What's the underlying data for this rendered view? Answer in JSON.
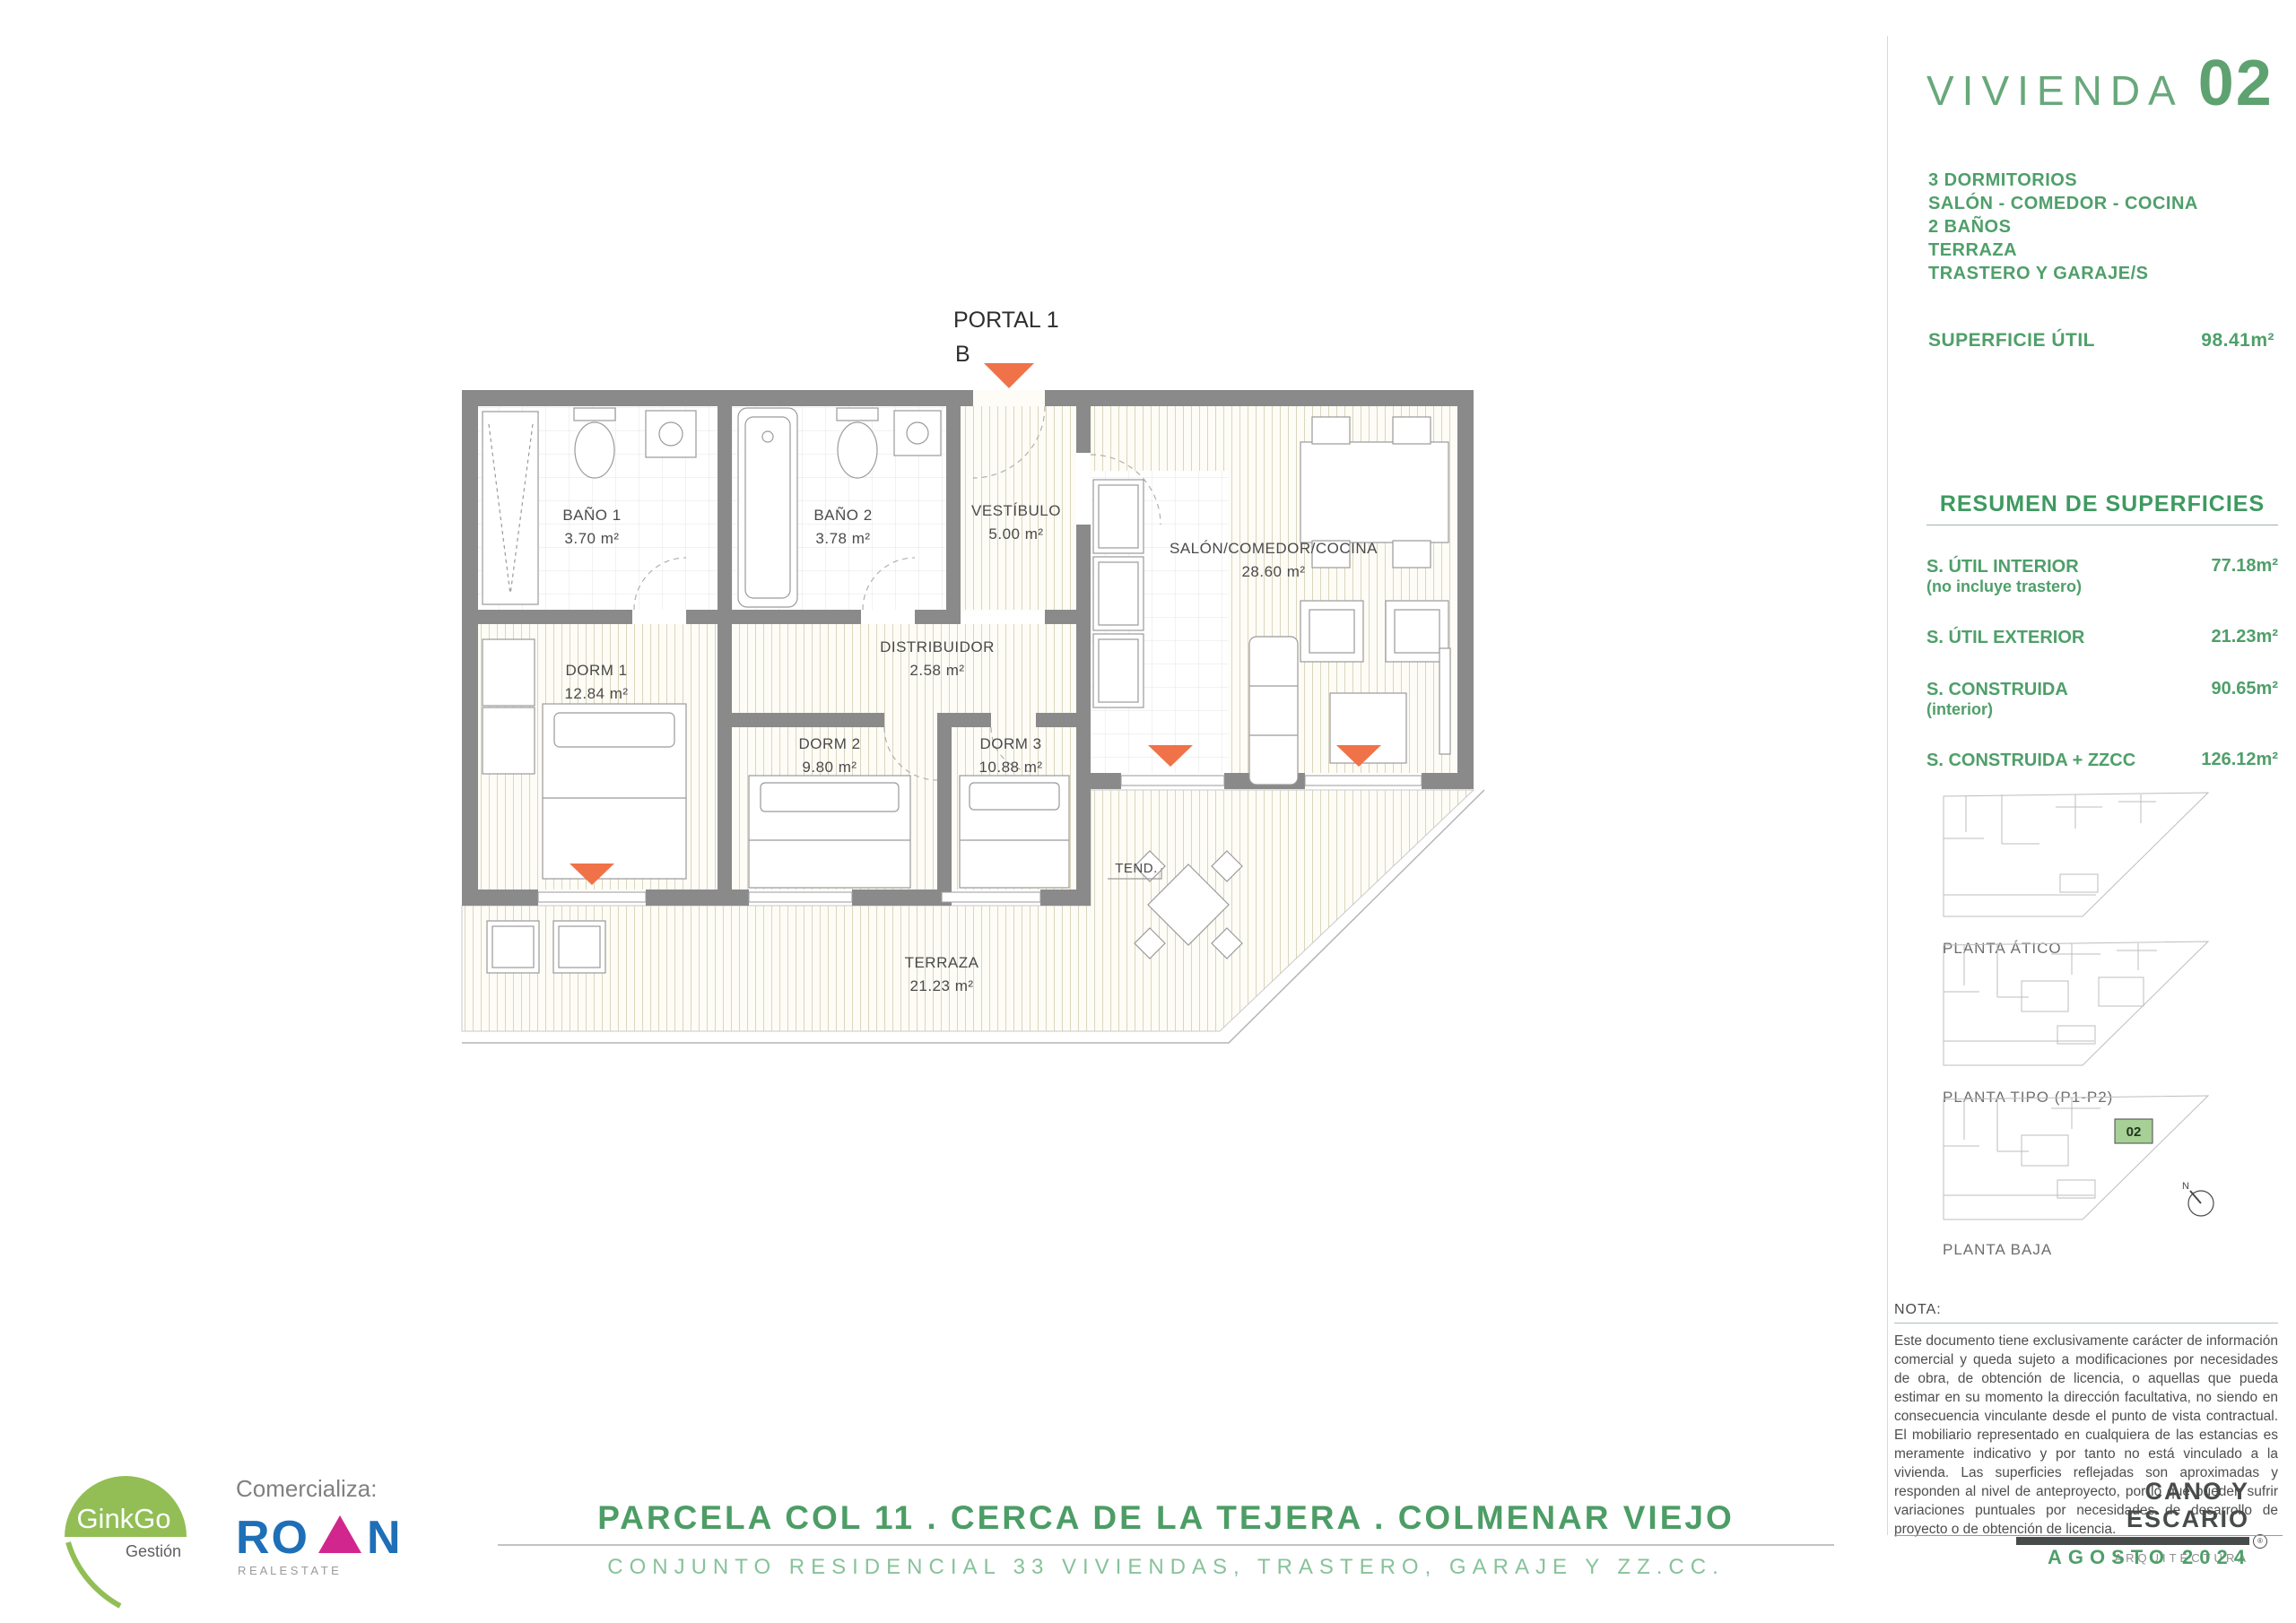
{
  "plan": {
    "portal_label": "PORTAL 1",
    "portal_letter": "B",
    "rooms": {
      "bano1": {
        "name": "BAÑO 1",
        "area": "3.70 m²"
      },
      "bano2": {
        "name": "BAÑO 2",
        "area": "3.78 m²"
      },
      "vestibulo": {
        "name": "VESTÍBULO",
        "area": "5.00 m²"
      },
      "distribuidor": {
        "name": "DISTRIBUIDOR",
        "area": "2.58 m²"
      },
      "dorm1": {
        "name": "DORM 1",
        "area": "12.84 m²"
      },
      "dorm2": {
        "name": "DORM 2",
        "area": "9.80 m²"
      },
      "dorm3": {
        "name": "DORM 3",
        "area": "10.88 m²"
      },
      "salon": {
        "name": "SALÓN/COMEDOR/COCINA",
        "area": "28.60 m²"
      },
      "terraza": {
        "name": "TERRAZA",
        "area": "21.23 m²"
      }
    },
    "tendedero": "TEND."
  },
  "panel": {
    "title": "VIVIENDA",
    "number": "02",
    "features": [
      "3 DORMITORIOS",
      "SALÓN - COMEDOR - COCINA",
      "2 BAÑOS",
      "TERRAZA",
      "TRASTERO Y GARAJE/S"
    ],
    "superficie_util": {
      "label": "SUPERFICIE ÚTIL",
      "value": "98.41m²"
    },
    "resumen": {
      "title": "RESUMEN DE SUPERFICIES",
      "rows": [
        {
          "label": "S. ÚTIL INTERIOR",
          "sub": "(no incluye trastero)",
          "value": "77.18m²"
        },
        {
          "label": "S. ÚTIL EXTERIOR",
          "sub": "",
          "value": "21.23m²"
        },
        {
          "label": "S. CONSTRUIDA",
          "sub": "(interior)",
          "value": "90.65m²"
        },
        {
          "label": "S. CONSTRUIDA + ZZCC",
          "sub": "",
          "value": "126.12m²"
        }
      ]
    },
    "thumbnails": {
      "atico": "PLANTA ÁTICO",
      "tipo": "PLANTA TIPO (P1-P2)",
      "baja": "PLANTA BAJA",
      "unit": "02",
      "compass": "N"
    },
    "nota": {
      "label": "NOTA:",
      "text": "Este documento tiene exclusivamente carácter de información comercial y queda sujeto a modificaciones por necesidades de obra, de obtención de licencia, o aquellas que pueda estimar en su momento la dirección facultativa, no siendo en consecuencia vinculante desde el punto de vista contractual. El mobiliario representado en cualquiera de las estancias es meramente indicativo y por tanto no está vinculado a la vivienda. Las superficies reflejadas son aproximadas y responden al nivel de anteproyecto, por lo que pueden sufrir variaciones puntuales por necesidades de desarrollo de proyecto o de obtención de licencia."
    },
    "architect": {
      "name": "CANO Y ESCARIO",
      "rmark": "®",
      "sub": "ARQUITECTURA",
      "date": "AGOSTO 2024"
    }
  },
  "footer": {
    "comercializa": "Comercializa:",
    "ginkgo": {
      "name": "GinkGo",
      "sub": "Gestión"
    },
    "roan": {
      "left": "RO",
      "right": "N",
      "sub": "R E A L   E S T A T E"
    },
    "line1": "PARCELA COL 11 . CERCA DE LA TEJERA . COLMENAR VIEJO",
    "line2": "CONJUNTO RESIDENCIAL 33 VIVIENDAS, TRASTERO, GARAJE Y ZZ.CC."
  },
  "colors": {
    "green_dark": "#3e9a60",
    "green": "#4f9f6a",
    "green_light": "#87c29a",
    "orange": "#f07248",
    "wall_gray": "#8a8a8a",
    "roan_blue": "#1e6fb7",
    "roan_pink": "#d2268f",
    "ginkgo_green": "#92be55"
  }
}
